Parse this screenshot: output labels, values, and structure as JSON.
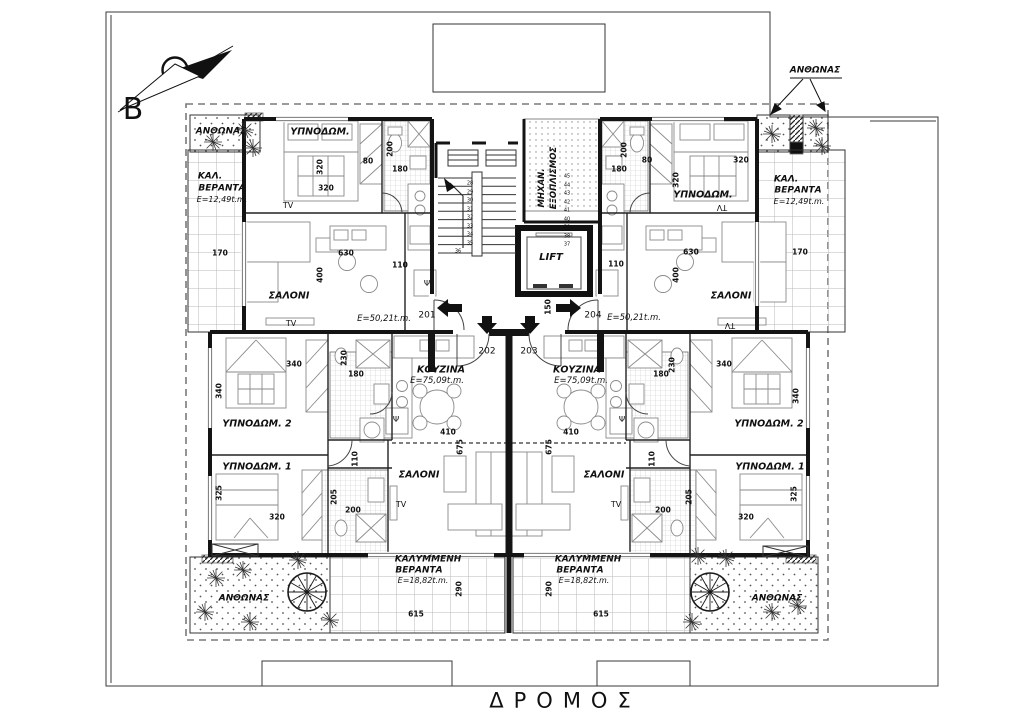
{
  "document": {
    "street_label": "ΔΡΟΜΟΣ",
    "north_letter": "B",
    "units": [
      {
        "number": "201",
        "area_label": "Ε=50,21t.m."
      },
      {
        "number": "202",
        "area_label": "Ε=75,09t.m."
      },
      {
        "number": "203",
        "area_label": "Ε=75,09t.m."
      },
      {
        "number": "204",
        "area_label": "Ε=50,21t.m."
      }
    ],
    "room_types": [
      "ΥΠΝΟΔΩΜ.",
      "ΥΠΝΟΔΩΜ. 1",
      "ΥΠΝΟΔΩΜ. 2",
      "ΣΑΛΟΝΙ",
      "ΚΟΥΖΙΝΑ",
      "ΚΑΛ. ΒΕΡΑΝΤΑ",
      "ΚΑΛΥΜΜΕΝΗ ΒΕΡΑΝΤΑ",
      "ΜΗΧΑΝ. ΕΞΟΠΛΙΣΜΟΣ",
      "LIFT",
      "ΑΝΘΩΝΑΣ"
    ],
    "style": {
      "line_color": "#141414",
      "hatch_color": "#b9b9b9",
      "boundary_dash_color": "#7a7a7a",
      "paper_color": "#ffffff"
    }
  },
  "labels": [
    {
      "n": "compass-letter",
      "t": "B",
      "x": 133,
      "y": 110,
      "s": 30,
      "b": 0,
      "i": 0
    },
    {
      "n": "street-label",
      "t": "ΔΡΟΜΟΣ",
      "x": 565,
      "y": 701,
      "s": 21,
      "b": 0,
      "i": 0,
      "ls": 10
    },
    {
      "n": "planter-label",
      "t": "ΑΝΘΩΝΑΣ",
      "x": 221,
      "y": 132,
      "s": 9,
      "b": 1,
      "i": 1
    },
    {
      "n": "planter-label",
      "t": "ΑΝΘΩΝΑΣ",
      "x": 815,
      "y": 71,
      "s": 9,
      "b": 1,
      "i": 1
    },
    {
      "n": "planter-label",
      "t": "ΑΝΘΩΝΑΣ",
      "x": 244,
      "y": 599,
      "s": 9,
      "b": 1,
      "i": 1
    },
    {
      "n": "planter-label",
      "t": "ΑΝΘΩΝΑΣ",
      "x": 777,
      "y": 599,
      "s": 9,
      "b": 1,
      "i": 1
    },
    {
      "n": "room-label-bedroom",
      "t": "ΥΠΝΟΔΩΜ.",
      "x": 320,
      "y": 132,
      "s": 9.5,
      "b": 1,
      "i": 1
    },
    {
      "n": "veranda-label",
      "t": "ΚΑΛ.",
      "x": 210,
      "y": 177,
      "s": 9,
      "b": 1,
      "i": 1
    },
    {
      "n": "veranda-label",
      "t": "ΒΕΡΑΝΤΑ",
      "x": 222,
      "y": 189,
      "s": 9,
      "b": 1,
      "i": 1
    },
    {
      "n": "area-label",
      "t": "Ε=12,49t.m.",
      "x": 222,
      "y": 200,
      "s": 8,
      "b": 0,
      "i": 1
    },
    {
      "n": "dim-label",
      "t": "320",
      "x": 320,
      "y": 167,
      "s": 7.5,
      "b": 1,
      "r": -90
    },
    {
      "n": "dim-label",
      "t": "80",
      "x": 368,
      "y": 161,
      "s": 7.5,
      "b": 1
    },
    {
      "n": "dim-label",
      "t": "200",
      "x": 390,
      "y": 149,
      "s": 7.5,
      "b": 1,
      "r": -90
    },
    {
      "n": "dim-label",
      "t": "180",
      "x": 400,
      "y": 169,
      "s": 7.5,
      "b": 1
    },
    {
      "n": "dim-label",
      "t": "320",
      "x": 326,
      "y": 188,
      "s": 7.5,
      "b": 1
    },
    {
      "n": "tv-label",
      "t": "TV",
      "x": 288,
      "y": 206,
      "s": 8,
      "b": 0
    },
    {
      "n": "dim-label",
      "t": "170",
      "x": 220,
      "y": 253,
      "s": 7.5,
      "b": 1
    },
    {
      "n": "room-label-living",
      "t": "ΣΑΛΟΝΙ",
      "x": 289,
      "y": 296,
      "s": 9.5,
      "b": 1,
      "i": 1
    },
    {
      "n": "tv-label",
      "t": "TV",
      "x": 291,
      "y": 324,
      "s": 8,
      "b": 0
    },
    {
      "n": "dim-label",
      "t": "630",
      "x": 346,
      "y": 253,
      "s": 7.5,
      "b": 1
    },
    {
      "n": "dim-label",
      "t": "400",
      "x": 320,
      "y": 275,
      "s": 7.5,
      "b": 1,
      "r": -90
    },
    {
      "n": "dim-label",
      "t": "110",
      "x": 400,
      "y": 265,
      "s": 7.5,
      "b": 1
    },
    {
      "n": "area-label",
      "t": "Ε=50,21t.m.",
      "x": 384,
      "y": 319,
      "s": 8.5,
      "b": 0,
      "i": 1
    },
    {
      "n": "unit-number",
      "t": "201",
      "x": 427,
      "y": 316,
      "s": 9,
      "b": 0
    },
    {
      "n": "room-label-bedroom",
      "t": "ΥΠΝΟΔΩΜ.",
      "x": 703,
      "y": 195,
      "s": 9.5,
      "b": 1,
      "i": 1
    },
    {
      "n": "tv-label",
      "t": "TV",
      "x": 722,
      "y": 207,
      "s": 8,
      "b": 0,
      "r": 180
    },
    {
      "n": "veranda-label",
      "t": "ΚΑΛ.",
      "x": 786,
      "y": 180,
      "s": 9,
      "b": 1,
      "i": 1
    },
    {
      "n": "veranda-label",
      "t": "ΒΕΡΑΝΤΑ",
      "x": 798,
      "y": 191,
      "s": 9,
      "b": 1,
      "i": 1
    },
    {
      "n": "area-label",
      "t": "Ε=12,49t.m.",
      "x": 799,
      "y": 202,
      "s": 8,
      "b": 0,
      "i": 1
    },
    {
      "n": "dim-label",
      "t": "320",
      "x": 741,
      "y": 160,
      "s": 7.5,
      "b": 1
    },
    {
      "n": "dim-label",
      "t": "320",
      "x": 676,
      "y": 180,
      "s": 7.5,
      "b": 1,
      "r": -90
    },
    {
      "n": "dim-label",
      "t": "80",
      "x": 647,
      "y": 160,
      "s": 7.5,
      "b": 1
    },
    {
      "n": "dim-label",
      "t": "180",
      "x": 619,
      "y": 169,
      "s": 7.5,
      "b": 1
    },
    {
      "n": "dim-label",
      "t": "200",
      "x": 624,
      "y": 150,
      "s": 7.5,
      "b": 1,
      "r": -90
    },
    {
      "n": "dim-label",
      "t": "110",
      "x": 616,
      "y": 264,
      "s": 7.5,
      "b": 1
    },
    {
      "n": "dim-label",
      "t": "630",
      "x": 691,
      "y": 252,
      "s": 7.5,
      "b": 1
    },
    {
      "n": "dim-label",
      "t": "170",
      "x": 800,
      "y": 252,
      "s": 7.5,
      "b": 1
    },
    {
      "n": "dim-label",
      "t": "400",
      "x": 676,
      "y": 275,
      "s": 7.5,
      "b": 1,
      "r": -90
    },
    {
      "n": "room-label-living",
      "t": "ΣΑΛΟΝΙ",
      "x": 731,
      "y": 296,
      "s": 9.5,
      "b": 1,
      "i": 1
    },
    {
      "n": "tv-label",
      "t": "TV",
      "x": 730,
      "y": 325,
      "s": 8,
      "b": 0,
      "r": 180
    },
    {
      "n": "area-label",
      "t": "Ε=50,21t.m.",
      "x": 634,
      "y": 318,
      "s": 8.5,
      "b": 0,
      "i": 1
    },
    {
      "n": "unit-number",
      "t": "204",
      "x": 593,
      "y": 316,
      "s": 9,
      "b": 0
    },
    {
      "n": "room-label-mech",
      "t": "ΜΗΧΑΝ.",
      "x": 542,
      "y": 188,
      "s": 8.5,
      "b": 1,
      "i": 1,
      "r": -90
    },
    {
      "n": "room-label-mech",
      "t": "ΕΞΟΠΛΙΣΜΟΣ",
      "x": 554,
      "y": 178,
      "s": 8.5,
      "b": 1,
      "i": 1,
      "r": -90
    },
    {
      "n": "room-label-lift",
      "t": "LIFT",
      "x": 551,
      "y": 258,
      "s": 10,
      "b": 1,
      "i": 1
    },
    {
      "n": "dim-label",
      "t": "150",
      "x": 548,
      "y": 307,
      "s": 7.5,
      "b": 1,
      "r": -90
    },
    {
      "n": "unit-number",
      "t": "202",
      "x": 487,
      "y": 352,
      "s": 9,
      "b": 0
    },
    {
      "n": "unit-number",
      "t": "203",
      "x": 529,
      "y": 352,
      "s": 9,
      "b": 0
    },
    {
      "n": "psi-symbol",
      "t": "Ψ",
      "x": 427,
      "y": 284,
      "s": 8,
      "b": 0
    },
    {
      "n": "psi-symbol",
      "t": "Ψ",
      "x": 590,
      "y": 284,
      "s": 8,
      "b": 0
    },
    {
      "n": "psi-symbol",
      "t": "Ψ",
      "x": 396,
      "y": 420,
      "s": 8,
      "b": 0
    },
    {
      "n": "psi-symbol",
      "t": "Ψ",
      "x": 622,
      "y": 420,
      "s": 8,
      "b": 0
    },
    {
      "n": "room-label-kitchen",
      "t": "ΚΟΥΖΙΝΑ",
      "x": 441,
      "y": 370,
      "s": 9.5,
      "b": 1,
      "i": 1
    },
    {
      "n": "area-label",
      "t": "Ε=75,09t.m.",
      "x": 437,
      "y": 381,
      "s": 8.5,
      "b": 0,
      "i": 1
    },
    {
      "n": "dim-label",
      "t": "410",
      "x": 448,
      "y": 432,
      "s": 7.5,
      "b": 1
    },
    {
      "n": "dim-label",
      "t": "675",
      "x": 460,
      "y": 447,
      "s": 7.5,
      "b": 1,
      "r": -90
    },
    {
      "n": "room-label-living",
      "t": "ΣΑΛΟΝΙ",
      "x": 419,
      "y": 475,
      "s": 9.5,
      "b": 1,
      "i": 1
    },
    {
      "n": "tv-label",
      "t": "TV",
      "x": 401,
      "y": 505,
      "s": 8,
      "b": 0
    },
    {
      "n": "room-label-bedroom",
      "t": "ΥΠΝΟΔΩΜ. 2",
      "x": 257,
      "y": 424,
      "s": 9.5,
      "b": 1,
      "i": 1
    },
    {
      "n": "dim-label",
      "t": "340",
      "x": 294,
      "y": 364,
      "s": 7.5,
      "b": 1
    },
    {
      "n": "dim-label",
      "t": "340",
      "x": 219,
      "y": 391,
      "s": 7.5,
      "b": 1,
      "r": -90
    },
    {
      "n": "dim-label",
      "t": "230",
      "x": 344,
      "y": 358,
      "s": 7.5,
      "b": 1,
      "r": -90
    },
    {
      "n": "dim-label",
      "t": "180",
      "x": 356,
      "y": 374,
      "s": 7.5,
      "b": 1
    },
    {
      "n": "room-label-bedroom",
      "t": "ΥΠΝΟΔΩΜ. 1",
      "x": 257,
      "y": 467,
      "s": 9.5,
      "b": 1,
      "i": 1
    },
    {
      "n": "dim-label",
      "t": "325",
      "x": 219,
      "y": 493,
      "s": 7.5,
      "b": 1,
      "r": -90
    },
    {
      "n": "dim-label",
      "t": "320",
      "x": 277,
      "y": 517,
      "s": 7.5,
      "b": 1
    },
    {
      "n": "dim-label",
      "t": "110",
      "x": 355,
      "y": 459,
      "s": 7.5,
      "b": 1,
      "r": -90
    },
    {
      "n": "dim-label",
      "t": "205",
      "x": 334,
      "y": 497,
      "s": 7.5,
      "b": 1,
      "r": -90
    },
    {
      "n": "dim-label",
      "t": "200",
      "x": 353,
      "y": 510,
      "s": 7.5,
      "b": 1
    },
    {
      "n": "room-label-kitchen",
      "t": "ΚΟΥΖΙΝΑ",
      "x": 577,
      "y": 370,
      "s": 9.5,
      "b": 1,
      "i": 1
    },
    {
      "n": "area-label",
      "t": "Ε=75,09t.m.",
      "x": 581,
      "y": 381,
      "s": 8.5,
      "b": 0,
      "i": 1
    },
    {
      "n": "dim-label",
      "t": "410",
      "x": 571,
      "y": 432,
      "s": 7.5,
      "b": 1
    },
    {
      "n": "dim-label",
      "t": "675",
      "x": 549,
      "y": 447,
      "s": 7.5,
      "b": 1,
      "r": -90
    },
    {
      "n": "room-label-living",
      "t": "ΣΑΛΟΝΙ",
      "x": 604,
      "y": 475,
      "s": 9.5,
      "b": 1,
      "i": 1
    },
    {
      "n": "tv-label",
      "t": "TV",
      "x": 616,
      "y": 505,
      "s": 8,
      "b": 0
    },
    {
      "n": "room-label-bedroom",
      "t": "ΥΠΝΟΔΩΜ. 2",
      "x": 769,
      "y": 424,
      "s": 9.5,
      "b": 1,
      "i": 1
    },
    {
      "n": "dim-label",
      "t": "340",
      "x": 724,
      "y": 364,
      "s": 7.5,
      "b": 1
    },
    {
      "n": "dim-label",
      "t": "340",
      "x": 796,
      "y": 396,
      "s": 7.5,
      "b": 1,
      "r": -90
    },
    {
      "n": "dim-label",
      "t": "230",
      "x": 672,
      "y": 365,
      "s": 7.5,
      "b": 1,
      "r": -90
    },
    {
      "n": "dim-label",
      "t": "180",
      "x": 661,
      "y": 374,
      "s": 7.5,
      "b": 1
    },
    {
      "n": "room-label-bedroom",
      "t": "ΥΠΝΟΔΩΜ. 1",
      "x": 770,
      "y": 467,
      "s": 9.5,
      "b": 1,
      "i": 1
    },
    {
      "n": "dim-label",
      "t": "325",
      "x": 794,
      "y": 494,
      "s": 7.5,
      "b": 1,
      "r": -90
    },
    {
      "n": "dim-label",
      "t": "320",
      "x": 746,
      "y": 517,
      "s": 7.5,
      "b": 1
    },
    {
      "n": "dim-label",
      "t": "110",
      "x": 652,
      "y": 459,
      "s": 7.5,
      "b": 1,
      "r": -90
    },
    {
      "n": "dim-label",
      "t": "205",
      "x": 689,
      "y": 497,
      "s": 7.5,
      "b": 1,
      "r": -90
    },
    {
      "n": "dim-label",
      "t": "200",
      "x": 663,
      "y": 510,
      "s": 7.5,
      "b": 1
    },
    {
      "n": "veranda-label",
      "t": "ΚΑΛΥΜΜΕΝΗ",
      "x": 428,
      "y": 560,
      "s": 9,
      "b": 1,
      "i": 1
    },
    {
      "n": "veranda-label",
      "t": "ΒΕΡΑΝΤΑ",
      "x": 419,
      "y": 571,
      "s": 9,
      "b": 1,
      "i": 1
    },
    {
      "n": "area-label",
      "t": "Ε=18,82t.m.",
      "x": 423,
      "y": 581,
      "s": 8,
      "b": 0,
      "i": 1
    },
    {
      "n": "dim-label",
      "t": "290",
      "x": 459,
      "y": 589,
      "s": 7.5,
      "b": 1,
      "r": -90
    },
    {
      "n": "dim-label",
      "t": "615",
      "x": 416,
      "y": 614,
      "s": 7.5,
      "b": 1
    },
    {
      "n": "veranda-label",
      "t": "ΚΑΛΥΜΜΕΝΗ",
      "x": 588,
      "y": 560,
      "s": 9,
      "b": 1,
      "i": 1
    },
    {
      "n": "veranda-label",
      "t": "ΒΕΡΑΝΤΑ",
      "x": 580,
      "y": 571,
      "s": 9,
      "b": 1,
      "i": 1
    },
    {
      "n": "area-label",
      "t": "Ε=18,82t.m.",
      "x": 584,
      "y": 581,
      "s": 8,
      "b": 0,
      "i": 1
    },
    {
      "n": "dim-label",
      "t": "290",
      "x": 549,
      "y": 589,
      "s": 7.5,
      "b": 1,
      "r": -90
    },
    {
      "n": "dim-label",
      "t": "615",
      "x": 601,
      "y": 614,
      "s": 7.5,
      "b": 1
    },
    {
      "n": "stair-step-number",
      "t": "28",
      "x": 470,
      "y": 184,
      "s": 5
    },
    {
      "n": "stair-step-number",
      "t": "29",
      "x": 470,
      "y": 192.5,
      "s": 5
    },
    {
      "n": "stair-step-number",
      "t": "30",
      "x": 470,
      "y": 201,
      "s": 5
    },
    {
      "n": "stair-step-number",
      "t": "31",
      "x": 470,
      "y": 209.5,
      "s": 5
    },
    {
      "n": "stair-step-number",
      "t": "32",
      "x": 470,
      "y": 218,
      "s": 5
    },
    {
      "n": "stair-step-number",
      "t": "33",
      "x": 470,
      "y": 226.5,
      "s": 5
    },
    {
      "n": "stair-step-number",
      "t": "34",
      "x": 470,
      "y": 235,
      "s": 5
    },
    {
      "n": "stair-step-number",
      "t": "35",
      "x": 470,
      "y": 243.5,
      "s": 5
    },
    {
      "n": "stair-step-number",
      "t": "36",
      "x": 458,
      "y": 252,
      "s": 5
    },
    {
      "n": "stair-step-number",
      "t": "45",
      "x": 567,
      "y": 177,
      "s": 5
    },
    {
      "n": "stair-step-number",
      "t": "44",
      "x": 567,
      "y": 185.5,
      "s": 5
    },
    {
      "n": "stair-step-number",
      "t": "43",
      "x": 567,
      "y": 194,
      "s": 5
    },
    {
      "n": "stair-step-number",
      "t": "42",
      "x": 567,
      "y": 202.5,
      "s": 5
    },
    {
      "n": "stair-step-number",
      "t": "41",
      "x": 567,
      "y": 211,
      "s": 5
    },
    {
      "n": "stair-step-number",
      "t": "40",
      "x": 567,
      "y": 219.5,
      "s": 5
    },
    {
      "n": "stair-step-number",
      "t": "39",
      "x": 567,
      "y": 228,
      "s": 5
    },
    {
      "n": "stair-step-number",
      "t": "38",
      "x": 567,
      "y": 236.5,
      "s": 5
    },
    {
      "n": "stair-step-number",
      "t": "37",
      "x": 567,
      "y": 245,
      "s": 5
    }
  ]
}
